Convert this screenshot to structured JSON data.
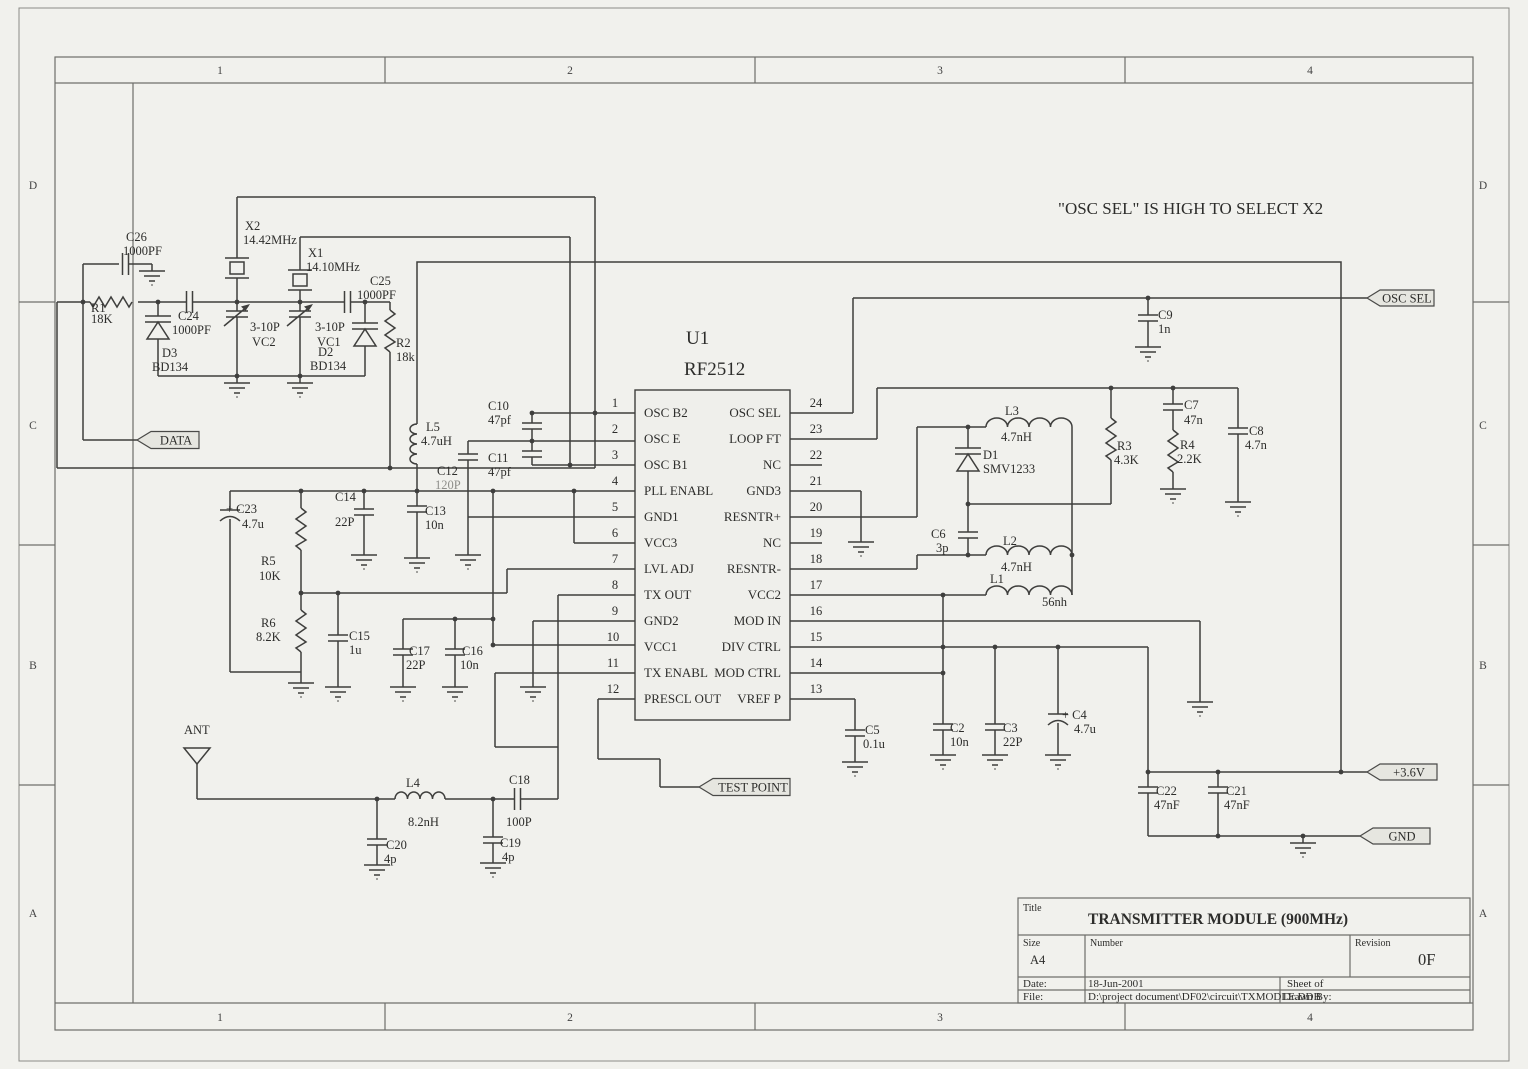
{
  "note": "\"OSC SEL\" IS HIGH TO SELECT X2",
  "border": {
    "cols": [
      "1",
      "2",
      "3",
      "4"
    ],
    "rows": [
      "D",
      "C",
      "B",
      "A"
    ]
  },
  "ic": {
    "ref": "U1",
    "part": "RF2512",
    "left_pins": [
      {
        "num": "1",
        "name": "OSC B2"
      },
      {
        "num": "2",
        "name": "OSC E"
      },
      {
        "num": "3",
        "name": "OSC B1"
      },
      {
        "num": "4",
        "name": "PLL ENABL"
      },
      {
        "num": "5",
        "name": "GND1"
      },
      {
        "num": "6",
        "name": "VCC3"
      },
      {
        "num": "7",
        "name": "LVL ADJ"
      },
      {
        "num": "8",
        "name": "TX OUT"
      },
      {
        "num": "9",
        "name": "GND2"
      },
      {
        "num": "10",
        "name": "VCC1"
      },
      {
        "num": "11",
        "name": "TX ENABL"
      },
      {
        "num": "12",
        "name": "PRESCL OUT"
      }
    ],
    "right_pins": [
      {
        "num": "24",
        "name": "OSC SEL"
      },
      {
        "num": "23",
        "name": "LOOP FT"
      },
      {
        "num": "22",
        "name": "NC"
      },
      {
        "num": "21",
        "name": "GND3"
      },
      {
        "num": "20",
        "name": "RESNTR+"
      },
      {
        "num": "19",
        "name": "NC"
      },
      {
        "num": "18",
        "name": "RESNTR-"
      },
      {
        "num": "17",
        "name": "VCC2"
      },
      {
        "num": "16",
        "name": "MOD IN"
      },
      {
        "num": "15",
        "name": "DIV CTRL"
      },
      {
        "num": "14",
        "name": "MOD CTRL"
      },
      {
        "num": "13",
        "name": "VREF P"
      }
    ]
  },
  "flags": {
    "data": "DATA",
    "test_point": "TEST POINT",
    "osc_sel": "OSC SEL",
    "v36": "+3.6V",
    "gnd": "GND"
  },
  "components": {
    "c26": {
      "ref": "C26",
      "value": "1000PF"
    },
    "r1": {
      "ref": "R1",
      "value": "18K"
    },
    "c24": {
      "ref": "C24",
      "value": "1000PF"
    },
    "d3": {
      "ref": "D3",
      "value": "BD134"
    },
    "x2": {
      "ref": "X2",
      "value": "14.42MHz"
    },
    "vc2": {
      "ref": "VC2",
      "value": "3-10P"
    },
    "x1": {
      "ref": "X1",
      "value": "14.10MHz"
    },
    "vc1": {
      "ref": "VC1",
      "value": "3-10P"
    },
    "c25": {
      "ref": "C25",
      "value": "1000PF"
    },
    "d2": {
      "ref": "D2",
      "value": "BD134"
    },
    "r2": {
      "ref": "R2",
      "value": "18k"
    },
    "l5": {
      "ref": "L5",
      "value": "4.7uH"
    },
    "c10": {
      "ref": "C10",
      "value": "47pf"
    },
    "c11": {
      "ref": "C11",
      "value": "47pf"
    },
    "c12": {
      "ref": "C12",
      "value": "120P"
    },
    "c14": {
      "ref": "C14",
      "value": "22P"
    },
    "c13": {
      "ref": "C13",
      "value": "10n"
    },
    "c23": {
      "ref": "+ C23",
      "value": "4.7u"
    },
    "r5": {
      "ref": "R5",
      "value": "10K"
    },
    "r6": {
      "ref": "R6",
      "value": "8.2K"
    },
    "c15": {
      "ref": "C15",
      "value": "1u"
    },
    "c17": {
      "ref": "C17",
      "value": "22P"
    },
    "c16": {
      "ref": "C16",
      "value": "10n"
    },
    "ant": {
      "ref": "ANT"
    },
    "l4": {
      "ref": "L4",
      "value": "8.2nH"
    },
    "c18": {
      "ref": "C18",
      "value": "100P"
    },
    "c20": {
      "ref": "C20",
      "value": "4p"
    },
    "c19": {
      "ref": "C19",
      "value": "4p"
    },
    "c9": {
      "ref": "C9",
      "value": "1n"
    },
    "l3": {
      "ref": "L3",
      "value": "4.7nH"
    },
    "d1": {
      "ref": "D1",
      "value": "SMV1233"
    },
    "c6": {
      "ref": "C6",
      "value": "3p"
    },
    "l2": {
      "ref": "L2",
      "value": "4.7nH"
    },
    "l1": {
      "ref": "L1",
      "value": "56nh"
    },
    "r3": {
      "ref": "R3",
      "value": "4.3K"
    },
    "c7": {
      "ref": "C7",
      "value": "47n"
    },
    "r4": {
      "ref": "R4",
      "value": "2.2K"
    },
    "c8": {
      "ref": "C8",
      "value": "4.7n"
    },
    "c5": {
      "ref": "C5",
      "value": "0.1u"
    },
    "c2": {
      "ref": "C2",
      "value": "10n"
    },
    "c3": {
      "ref": "C3",
      "value": "22P"
    },
    "c4": {
      "ref": "+ C4",
      "value": "4.7u"
    },
    "c22": {
      "ref": "C22",
      "value": "47nF"
    },
    "c21": {
      "ref": "C21",
      "value": "47nF"
    }
  },
  "title_block": {
    "title_label": "Title",
    "title": "TRANSMITTER MODULE (900MHz)",
    "size_label": "Size",
    "size": "A4",
    "number_label": "Number",
    "revision_label": "Revision",
    "revision": "0F",
    "date_label": "Date:",
    "date": "18-Jun-2001",
    "sheet_label": "Sheet    of",
    "file_label": "File:",
    "file": "D:\\project document\\DF02\\circuit\\TXMODLE.DDB",
    "drawn_label": "Drawn By:"
  }
}
